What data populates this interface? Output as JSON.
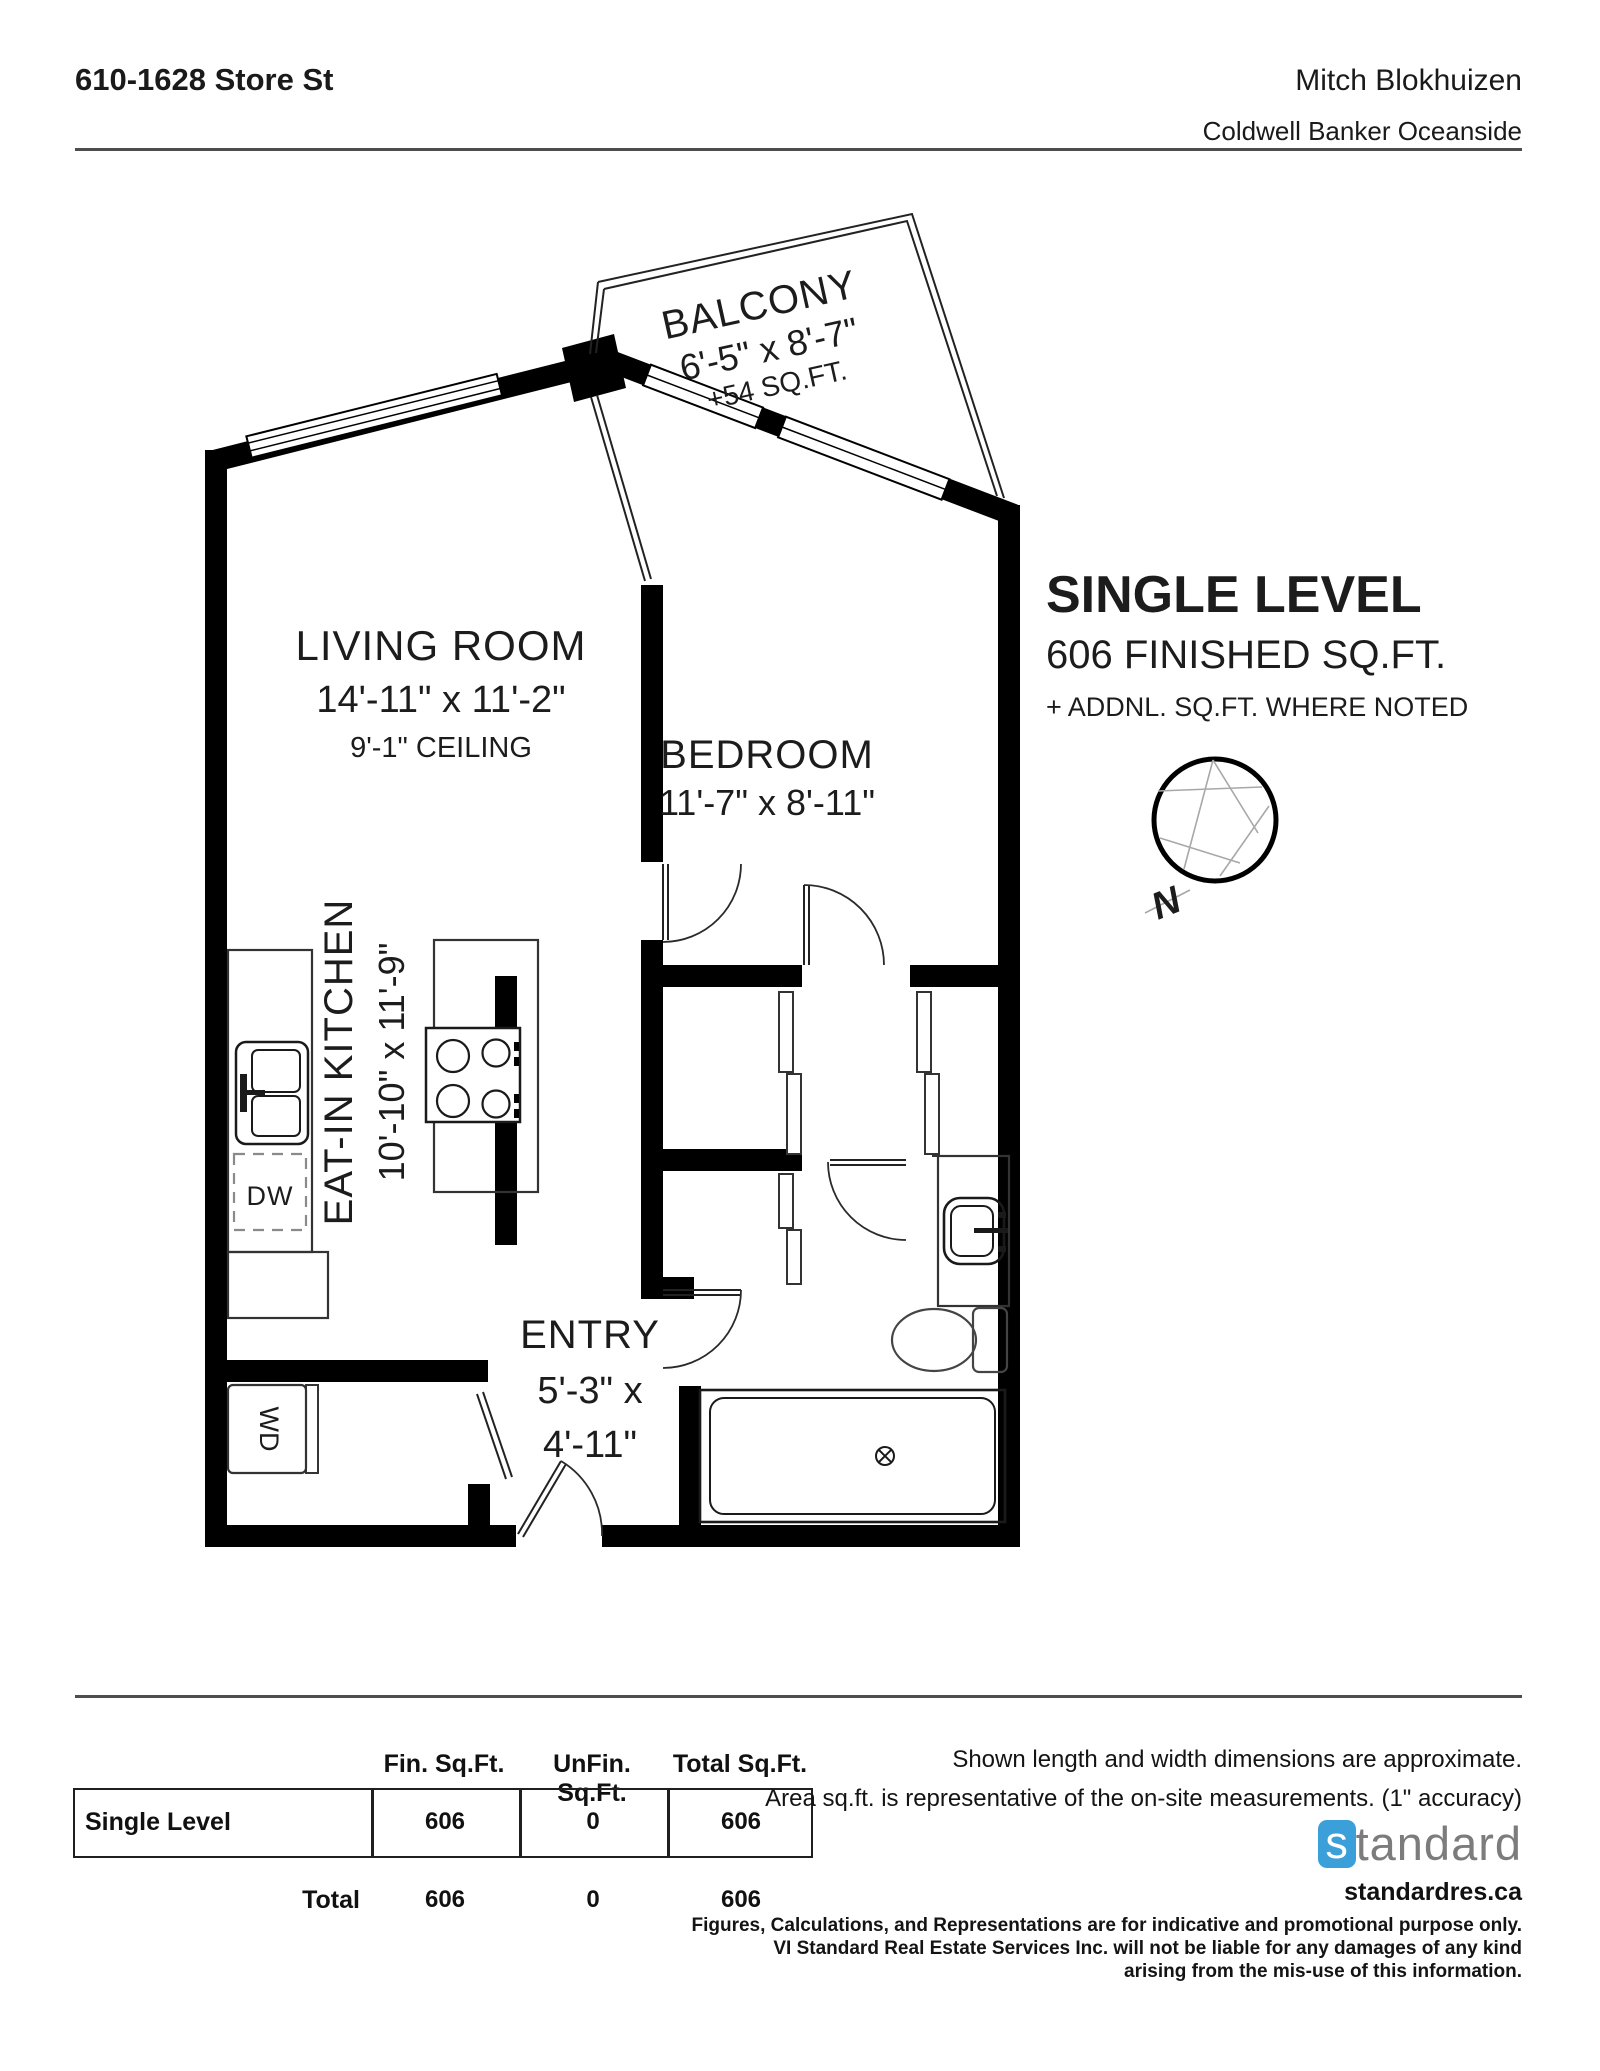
{
  "header": {
    "address": "610-1628 Store St",
    "agent": "Mitch Blokhuizen",
    "brokerage": "Coldwell Banker Oceanside"
  },
  "summary": {
    "title": "SINGLE LEVEL",
    "subtitle": "606 FINISHED SQ.FT.",
    "note": "+ ADDNL. SQ.FT. WHERE NOTED",
    "compass_letter": "N"
  },
  "rooms": {
    "balcony": {
      "name": "BALCONY",
      "dims": "6'-5\" x 8'-7\"",
      "area": "+54 SQ.FT."
    },
    "living": {
      "name": "LIVING ROOM",
      "dims": "14'-11\" x 11'-2\"",
      "ceiling": "9'-1\" CEILING"
    },
    "bedroom": {
      "name": "BEDROOM",
      "dims": "11'-7\" x 8'-11\""
    },
    "kitchen": {
      "name": "EAT-IN KITCHEN",
      "dims": "10'-10\" x 11'-9\""
    },
    "entry": {
      "name": "ENTRY",
      "dims1": "5'-3\" x",
      "dims2": "4'-11\""
    },
    "appliances": {
      "dishwasher": "DW",
      "washer_dryer": "WD"
    }
  },
  "table": {
    "headers": [
      "Fin. Sq.Ft.",
      "UnFin. Sq.Ft.",
      "Total Sq.Ft."
    ],
    "rows": [
      {
        "label": "Single Level",
        "fin": "606",
        "unfin": "0",
        "total": "606"
      }
    ],
    "total_label": "Total",
    "total": {
      "fin": "606",
      "unfin": "0",
      "total": "606"
    }
  },
  "notes": {
    "line1": "Shown length and width dimensions are approximate.",
    "line2": "Area sq.ft. is representative of the on-site measurements. (1\" accuracy)"
  },
  "footer": {
    "logo_first": "s",
    "logo_rest": "tandard",
    "website": "standardres.ca",
    "disclaimer1": "Figures, Calculations, and Representations are for indicative and promotional purpose only.",
    "disclaimer2": "VI Standard Real Estate Services Inc. will not be liable for any damages of any kind",
    "disclaimer3": "arising from the mis-use of this information.",
    "brand_blue": "#3b9fd9"
  }
}
